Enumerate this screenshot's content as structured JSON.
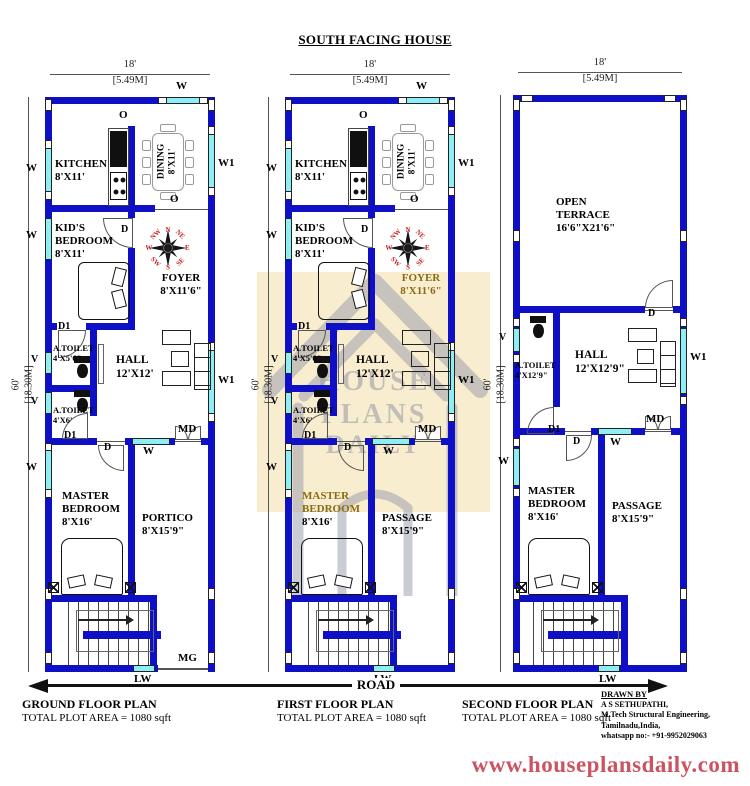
{
  "title": "SOUTH FACING HOUSE",
  "dims": {
    "w_ft": "18'",
    "w_m": "[5.49M]",
    "h_ft": "60'",
    "h_m": "[18.30M]"
  },
  "markers": {
    "w": "W",
    "w1": "W1",
    "v": "V",
    "o": "O",
    "d": "D",
    "d1": "D1",
    "md": "MD",
    "mg": "MG",
    "lw": "LW"
  },
  "compass": [
    "N",
    "NE",
    "E",
    "SE",
    "S",
    "SW",
    "W",
    "NW"
  ],
  "watermark": {
    "l1": "HOUSE",
    "l2": "PLANS",
    "l3": "DAILY"
  },
  "road": "ROAD",
  "website": "www.houseplansdaily.com",
  "credits": {
    "heading": "DRAWN BY",
    "name": "A S SETHUPATHI,",
    "qualification": "M.Tech Structural Engineering,",
    "location": "Tamilnadu,India,",
    "phone": "whatsapp no:- +91-9952029063"
  },
  "colors": {
    "wall_blue": "#0f0fc5",
    "window_cyan": "#8deef6",
    "compass_red": "#cc2222",
    "highlight_gold": "#8a6b15",
    "website_red": "#cc5462",
    "watermark_cream": "#f8edcf"
  },
  "plans": {
    "ground": {
      "name": "GROUND FLOOR PLAN",
      "area": "TOTAL PLOT AREA = 1080 sqft",
      "rooms": {
        "kitchen": {
          "n": "KITCHEN",
          "s": "8'X11'"
        },
        "dining": {
          "n": "DINING",
          "s": "8'X11'"
        },
        "kids": {
          "n1": "KID'S",
          "n2": "BEDROOM",
          "s": "8'X11'"
        },
        "foyer": {
          "n": "FOYER",
          "s": "8'X11'6\""
        },
        "toilet1": {
          "n": "A.TOILET",
          "s": "4'X5'6\""
        },
        "toilet2": {
          "n": "A.TOILET",
          "s": "4'X6'"
        },
        "hall": {
          "n": "HALL",
          "s": "12'X12'"
        },
        "master": {
          "n1": "MASTER",
          "n2": "BEDROOM",
          "s": "8'X16'"
        },
        "portico": {
          "n": "PORTICO",
          "s": "8'X15'9\""
        }
      }
    },
    "first": {
      "name": "FIRST FLOOR PLAN",
      "area": "TOTAL PLOT AREA = 1080 sqft",
      "rooms": {
        "kitchen": {
          "n": "KITCHEN",
          "s": "8'X11'"
        },
        "dining": {
          "n": "DINING",
          "s": "8'X11'"
        },
        "kids": {
          "n1": "KID'S",
          "n2": "BEDROOM",
          "s": "8'X11'"
        },
        "foyer": {
          "n": "FOYER",
          "s": "8'X11'6\""
        },
        "toilet1": {
          "n": "A.TOILET",
          "s": "4'X5'6\""
        },
        "toilet2": {
          "n": "A.TOILET",
          "s": "4'X6'"
        },
        "hall": {
          "n": "HALL",
          "s": "12'X12'"
        },
        "master": {
          "n1": "MASTER",
          "n2": "BEDROOM",
          "s": "8'X16'"
        },
        "passage": {
          "n": "PASSAGE",
          "s": "8'X15'9\""
        }
      }
    },
    "second": {
      "name": "SECOND FLOOR PLAN",
      "area": "TOTAL PLOT AREA = 1080 sqft",
      "rooms": {
        "terrace": {
          "n1": "OPEN",
          "n2": "TERRACE",
          "s": "16'6\"X21'6\""
        },
        "toilet": {
          "n": "A.TOILET",
          "s": "4'X12'9\""
        },
        "hall": {
          "n": "HALL",
          "s": "12'X12'9\""
        },
        "master": {
          "n1": "MASTER",
          "n2": "BEDROOM",
          "s": "8'X16'"
        },
        "passage": {
          "n": "PASSAGE",
          "s": "8'X15'9\""
        }
      }
    }
  }
}
